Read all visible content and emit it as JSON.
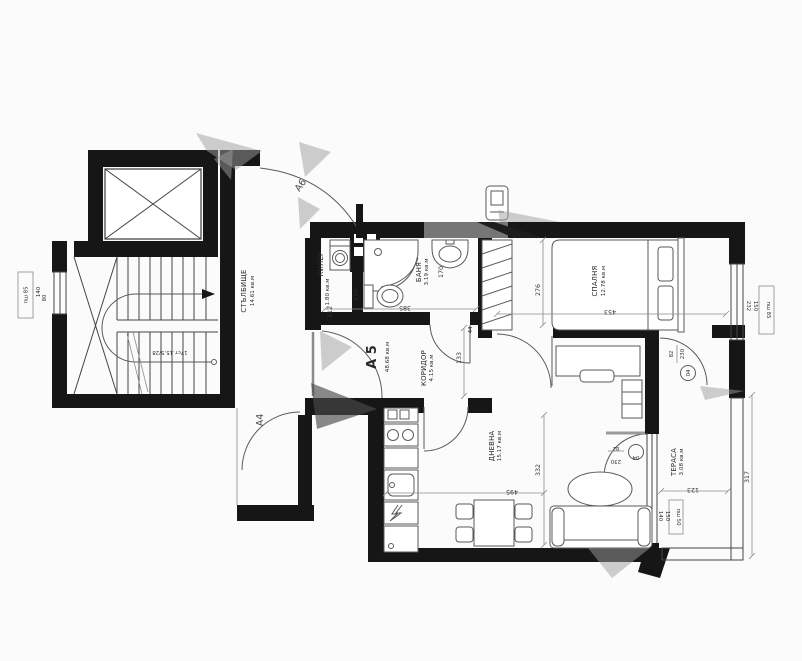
{
  "title": "Architectural floor plan — apartment А 5",
  "colors": {
    "wall": "#161616",
    "furniture_line": "#5a5a5a",
    "dim_line": "#8c8c8c",
    "text": "#2a2a2a",
    "watermark": "#9e9e9e",
    "background": "#fbfbfb"
  },
  "apartment": {
    "id": "А 5",
    "area": "48.68 кв.м"
  },
  "rooms": [
    {
      "name": "СТЪЛБИЩЕ",
      "area": "14.61 кв.м"
    },
    {
      "name": "КИЛЕР",
      "area": "1.80 кв.м"
    },
    {
      "name": "БАНЯ",
      "area": "3.19 кв.м"
    },
    {
      "name": "КОРИДОР",
      "area": "4.15 кв.м"
    },
    {
      "name": "СПАЛНЯ",
      "area": "12.78 кв.м"
    },
    {
      "name": "ДНЕВНА",
      "area": "15.17 кв.м"
    },
    {
      "name": "ТЕРАСА",
      "area": "3.08 кв.м"
    }
  ],
  "doors": {
    "a6": "А6",
    "a4": "А4",
    "terrace_bedroom": {
      "size_top": "82",
      "size_bottom": "230",
      "ref": "04"
    },
    "terrace_living": {
      "size_top": "82",
      "size_bottom": "230",
      "ref": "04"
    }
  },
  "windows": {
    "west": {
      "w": "140",
      "h": "80",
      "tag": "пш 85"
    },
    "east": {
      "w": "232",
      "h": "150",
      "tag": "пш 85"
    },
    "terrace": {
      "w": "140",
      "h": "150",
      "tag": "пш 50"
    }
  },
  "stairs": {
    "spec": "17ст.15.5/28"
  },
  "dims": {
    "bedroom_h": "276",
    "bedroom_w": "453",
    "bath_w": "385",
    "entry": "112",
    "closet": "170",
    "bath": "170",
    "passage": "133",
    "gap": "44",
    "living_h": "332",
    "living_w": "495",
    "terrace_w": "123",
    "terrace_h": "317"
  }
}
